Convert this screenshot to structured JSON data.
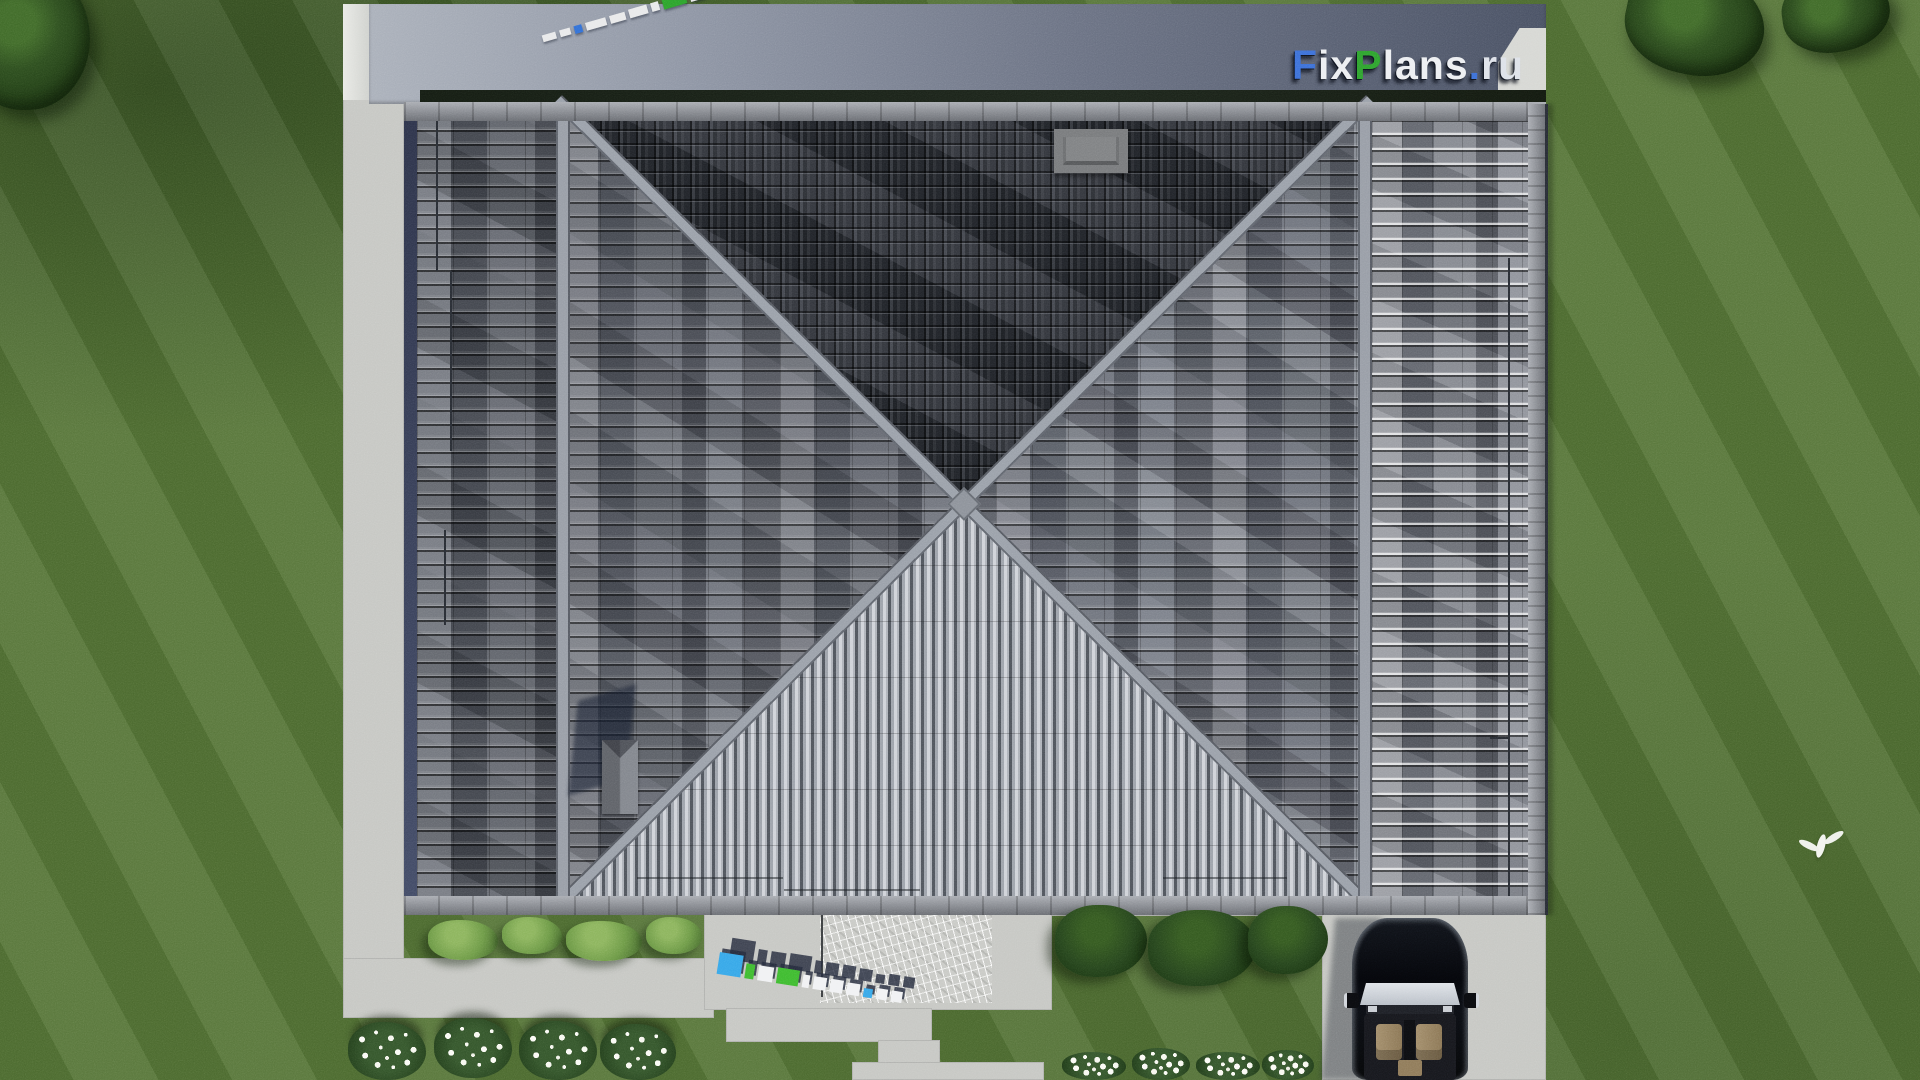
{
  "brand": {
    "name": "FixPlans.ru",
    "parts": [
      {
        "t": "F",
        "color": "blue"
      },
      {
        "t": "ix",
        "color": "white"
      },
      {
        "t": "P",
        "color": "green"
      },
      {
        "t": "lans",
        "color": "white"
      },
      {
        "t": ".",
        "color": "blue"
      },
      {
        "t": "ru",
        "color": "silver"
      }
    ]
  },
  "watermarks": {
    "top_left_text": "FixPlans.ru",
    "bottom_center_text": "FixPlans.ru"
  },
  "palette": {
    "grass": "#507031",
    "concrete": "#c6c7c3",
    "concrete_shadow": "#485063",
    "roof_dark_face": "#272a31",
    "roof_side_face": "#575b64",
    "roof_bright_face": "#c2c5cb",
    "ridge": "#8e939b",
    "gutter": "#2b3148",
    "logo_blue": "#2f6fd6",
    "logo_green": "#2aa32a",
    "car_body": "#0b0c0e",
    "car_interior": "#9c8766"
  }
}
